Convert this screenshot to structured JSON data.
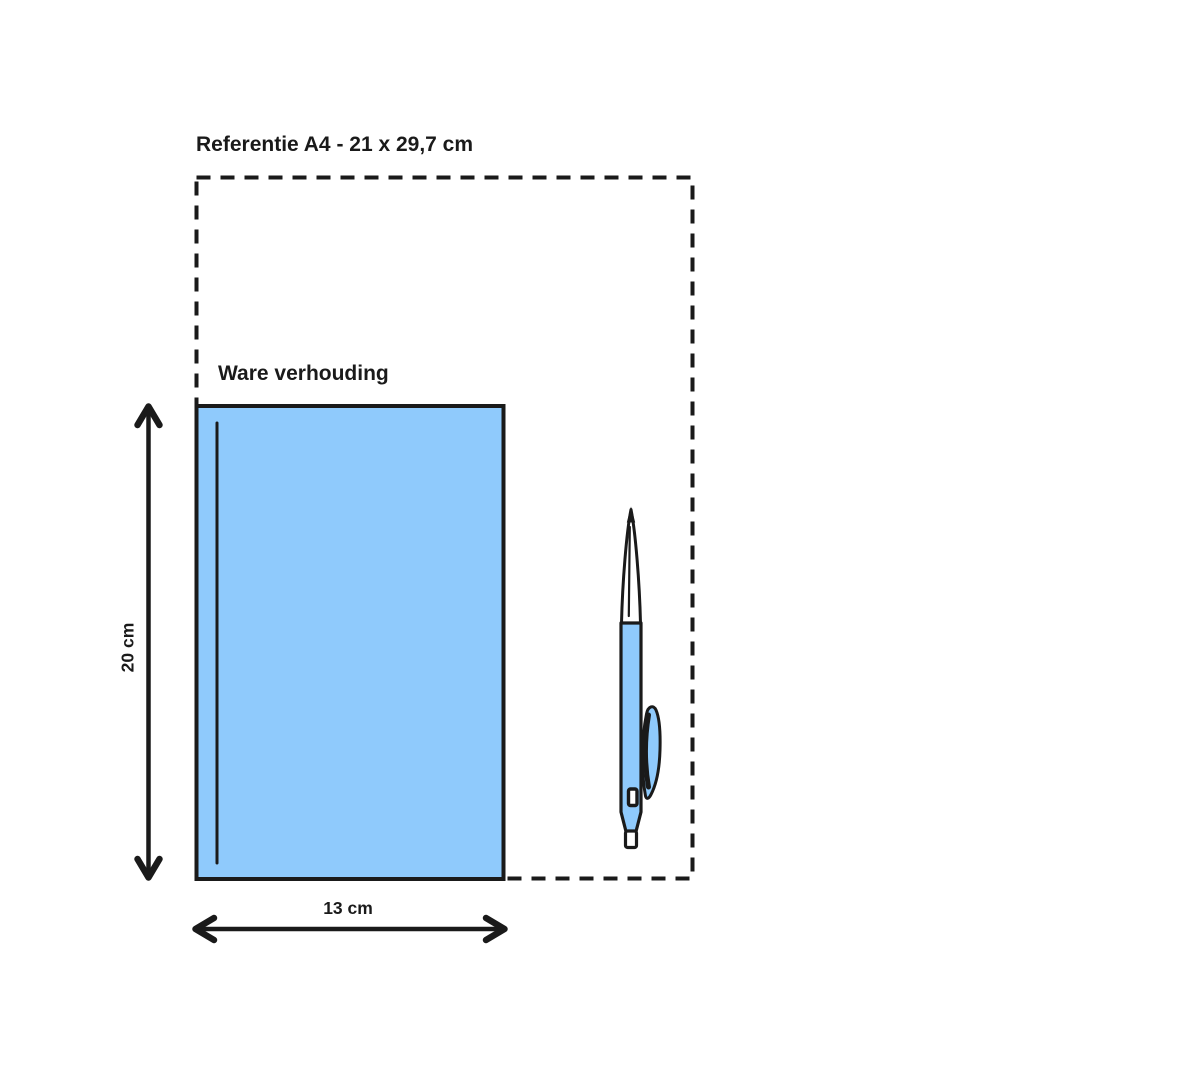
{
  "colors": {
    "background": "#ffffff",
    "ink": "#1a1a1a",
    "fill_blue": "#8fcafc",
    "white": "#ffffff"
  },
  "labels": {
    "reference_title": "Referentie A4 - 21 x 29,7 cm",
    "object_caption": "Ware verhouding",
    "height_dimension": "20 cm",
    "width_dimension": "13 cm"
  },
  "measurements": {
    "reference_format": "A4",
    "reference_size_cm": "21 x 29,7",
    "object_width_cm": "13",
    "object_height_cm": "20"
  },
  "icons": {
    "pen": "ballpoint-pen-illustration"
  }
}
